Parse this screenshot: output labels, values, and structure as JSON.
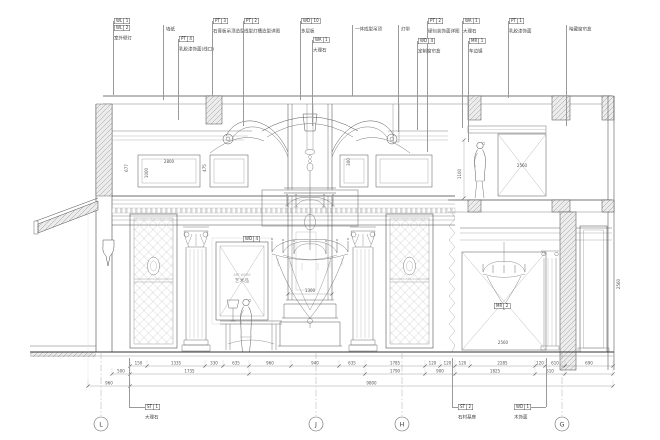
{
  "colors": {
    "line": "#4a4a4a",
    "light": "#8a8a8a",
    "dim": "#555555",
    "hatch": "#9a9a9a",
    "accent": "#b8b8b8"
  },
  "drawing": {
    "artwork": {
      "sublabel": "ART WORK",
      "label": "艺术品"
    },
    "grid_bubbles": [
      {
        "x": 101,
        "label": "L"
      },
      {
        "x": 316,
        "label": "J"
      },
      {
        "x": 402,
        "label": "H"
      },
      {
        "x": 562,
        "label": "G"
      }
    ],
    "callouts_top": [
      {
        "x": 113,
        "tags": [
          "WL 1",
          "WL 2"
        ],
        "text": "室外壁灯",
        "ty": 18,
        "ly": 95
      },
      {
        "x": 163,
        "tags": [],
        "text": "墙纸",
        "ty": 22,
        "ly": 100
      },
      {
        "x": 178,
        "tags": [
          "PT 4"
        ],
        "text": "乳胶漆饰面(线口)",
        "ty": 36,
        "ly": 120
      },
      {
        "x": 212,
        "tags": [
          "PT 3"
        ],
        "text": "石膏板吊顶造型",
        "ty": 18,
        "ly": 96
      },
      {
        "x": 243,
        "tags": [
          "PT 2"
        ],
        "text": "线型灯槽造型详图",
        "ty": 18,
        "ly": 126
      },
      {
        "x": 300,
        "tags": [
          "WD 10"
        ],
        "text": "多层板",
        "ty": 18,
        "ly": 100
      },
      {
        "x": 312,
        "tags": [
          "WA 1"
        ],
        "text": "大理石",
        "ty": 37,
        "ly": 126
      },
      {
        "x": 352,
        "tags": [],
        "text": "一体成型吊顶",
        "ty": 22,
        "ly": 96
      },
      {
        "x": 398,
        "tags": [],
        "text": "灯带",
        "ty": 22,
        "ly": 132
      },
      {
        "x": 427,
        "tags": [
          "PT 2"
        ],
        "text": "硬包装饰面详图",
        "ty": 18,
        "ly": 152
      },
      {
        "x": 417,
        "tags": [
          "WD 4"
        ],
        "text": "定制窗帘盒",
        "ty": 38,
        "ly": 130
      },
      {
        "x": 462,
        "tags": [
          "WA 1"
        ],
        "text": "大理石",
        "ty": 18,
        "ly": 128
      },
      {
        "x": 468,
        "tags": [
          "MR 1"
        ],
        "text": "车边镜",
        "ty": 38,
        "ly": 142
      },
      {
        "x": 508,
        "tags": [
          "PT 1"
        ],
        "text": "乳胶漆饰面",
        "ty": 18,
        "ly": 98
      },
      {
        "x": 566,
        "tags": [],
        "text": "暗藏窗帘盒",
        "ty": 22,
        "ly": 126
      }
    ],
    "callouts_bottom": [
      {
        "x": 129,
        "bx": 145,
        "by": 404,
        "tag": "ST 1",
        "text": "大理石"
      },
      {
        "x": 452,
        "bx": 458,
        "by": 404,
        "tag": "ST 2",
        "text": "石材基座"
      },
      {
        "x": 546,
        "bx": 514,
        "by": 404,
        "tag": "WD 1",
        "text": "木饰面"
      }
    ],
    "callouts_inner": [
      {
        "x": 243,
        "y": 236,
        "tag": "WD 4"
      },
      {
        "x": 494,
        "y": 303,
        "tag": "MR 2"
      }
    ],
    "dim_labels": [
      {
        "x": 169,
        "y": 163,
        "t": "2800"
      },
      {
        "x": 148,
        "y": 173,
        "t": "1000",
        "rot": true
      },
      {
        "x": 128,
        "y": 168,
        "t": "677",
        "rot": true
      },
      {
        "x": 206,
        "y": 168,
        "t": "475",
        "rot": true
      },
      {
        "x": 350,
        "y": 162,
        "t": "300",
        "rot": true
      },
      {
        "x": 310,
        "y": 292,
        "t": "1300"
      },
      {
        "x": 522,
        "y": 167,
        "t": "2560"
      },
      {
        "x": 461,
        "y": 174,
        "t": "1100",
        "rot": true
      },
      {
        "x": 503,
        "y": 344,
        "t": "2560"
      },
      {
        "x": 620,
        "y": 284,
        "t": "2560",
        "rot": true
      },
      {
        "x": 242,
        "y": 276,
        "t": "ART WORK",
        "fs": 3.2,
        "c": "#aaaaaa"
      },
      {
        "x": 242,
        "y": 282,
        "t": "艺术品",
        "fs": 4.8,
        "c": "#8a8a8a"
      }
    ],
    "dim_rows": [
      {
        "y": 366,
        "segs": [
          [
            130,
            147,
            "150"
          ],
          [
            147,
            205,
            "1335"
          ],
          [
            205,
            223,
            "330"
          ],
          [
            223,
            249,
            "635"
          ],
          [
            249,
            291,
            "960"
          ],
          [
            291,
            339,
            "940"
          ],
          [
            339,
            365,
            "635"
          ],
          [
            365,
            425,
            "1785"
          ],
          [
            425,
            440,
            "120"
          ],
          [
            440,
            455,
            "120"
          ],
          [
            455,
            470,
            "120"
          ],
          [
            470,
            535,
            "2285"
          ],
          [
            535,
            545,
            "120"
          ],
          [
            545,
            565,
            "610"
          ],
          [
            565,
            613,
            "690"
          ]
        ]
      },
      {
        "y": 374,
        "segs": [
          [
            112,
            130,
            "500"
          ],
          [
            130,
            249,
            "1735"
          ],
          [
            249,
            365,
            ""
          ],
          [
            365,
            425,
            "1790"
          ],
          [
            425,
            455,
            "900"
          ],
          [
            455,
            535,
            "1825"
          ],
          [
            535,
            565,
            "610"
          ],
          [
            565,
            613,
            ""
          ]
        ]
      },
      {
        "y": 386,
        "segs": [
          [
            88,
            130,
            "960"
          ],
          [
            130,
            613,
            "9800"
          ]
        ]
      }
    ]
  }
}
